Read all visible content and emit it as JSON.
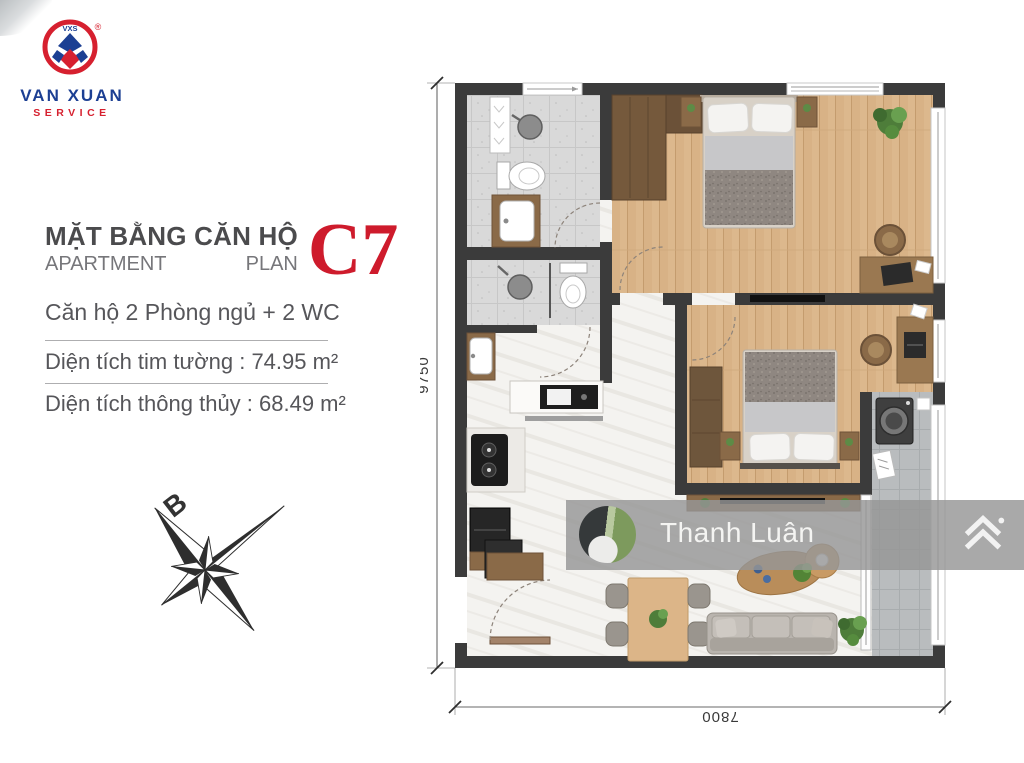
{
  "brand": {
    "monogram": "VXS",
    "registered_mark": "®",
    "name_line1": "VAN XUAN",
    "name_line2": "SERVICE"
  },
  "header": {
    "title_vi": "MẶT BẰNG CĂN HỘ",
    "title_en_word1": "APARTMENT",
    "title_en_word2": "PLAN",
    "unit_code": "C7"
  },
  "details": {
    "layout_line": "Căn hộ 2 Phòng ngủ + 2 WC",
    "area_rows": [
      {
        "text": "Diện tích tim tường : 74.95 m²"
      },
      {
        "text": "Diện tích thông thủy : 68.49 m²"
      }
    ]
  },
  "compass": {
    "north_label": "B"
  },
  "floor_plan": {
    "dimension_height": "9750",
    "dimension_width": "7800"
  },
  "watermark": {
    "display_name": "Thanh Luân"
  },
  "colors": {
    "accent_red": "#ce1b2c",
    "brand_blue": "#1c3f93",
    "wall_dark": "#3b3b3b",
    "wood_floor": "#d8b286",
    "bath_tile": "#d9d9d9",
    "balcony_tile": "#b9bcbe",
    "marble_floor": "#f4f3f0",
    "watermark_band": "rgba(150,150,150,0.82)"
  }
}
